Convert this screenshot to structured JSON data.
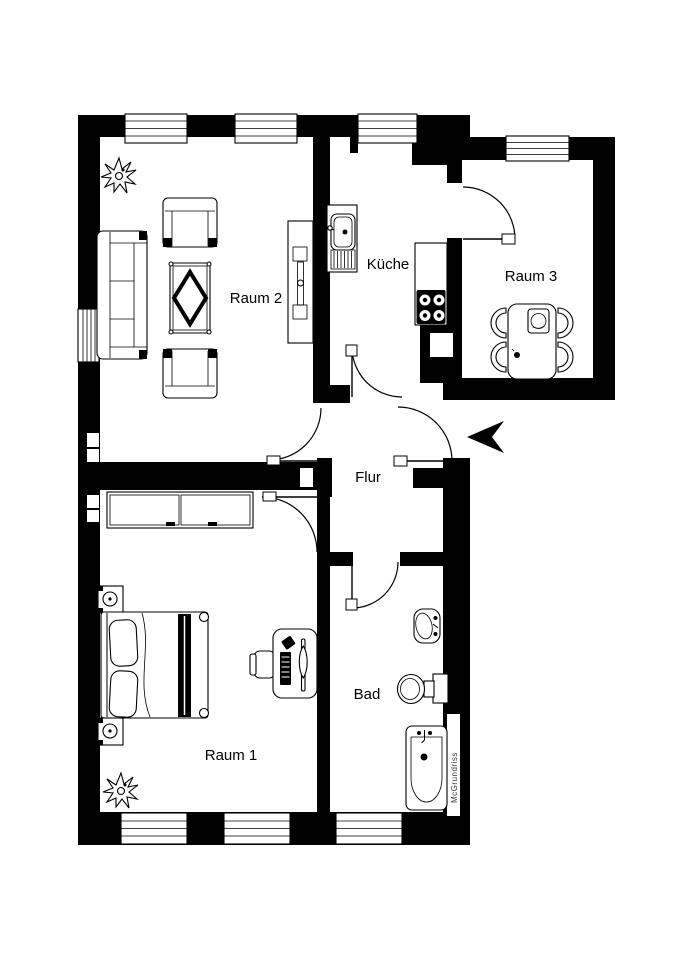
{
  "plan": {
    "title": "Wohnung Grundriss",
    "rooms": [
      {
        "id": "raum2",
        "label": "Raum 2"
      },
      {
        "id": "kueche",
        "label": "Küche"
      },
      {
        "id": "raum3",
        "label": "Raum 3"
      },
      {
        "id": "flur",
        "label": "Flur"
      },
      {
        "id": "raum1",
        "label": "Raum 1"
      },
      {
        "id": "bad",
        "label": "Bad"
      }
    ],
    "watermark": "McGrundriss",
    "colors": {
      "wall": "#000000",
      "floor": "#ffffff",
      "line": "#000000",
      "watermark": "#3a3a3a"
    }
  }
}
